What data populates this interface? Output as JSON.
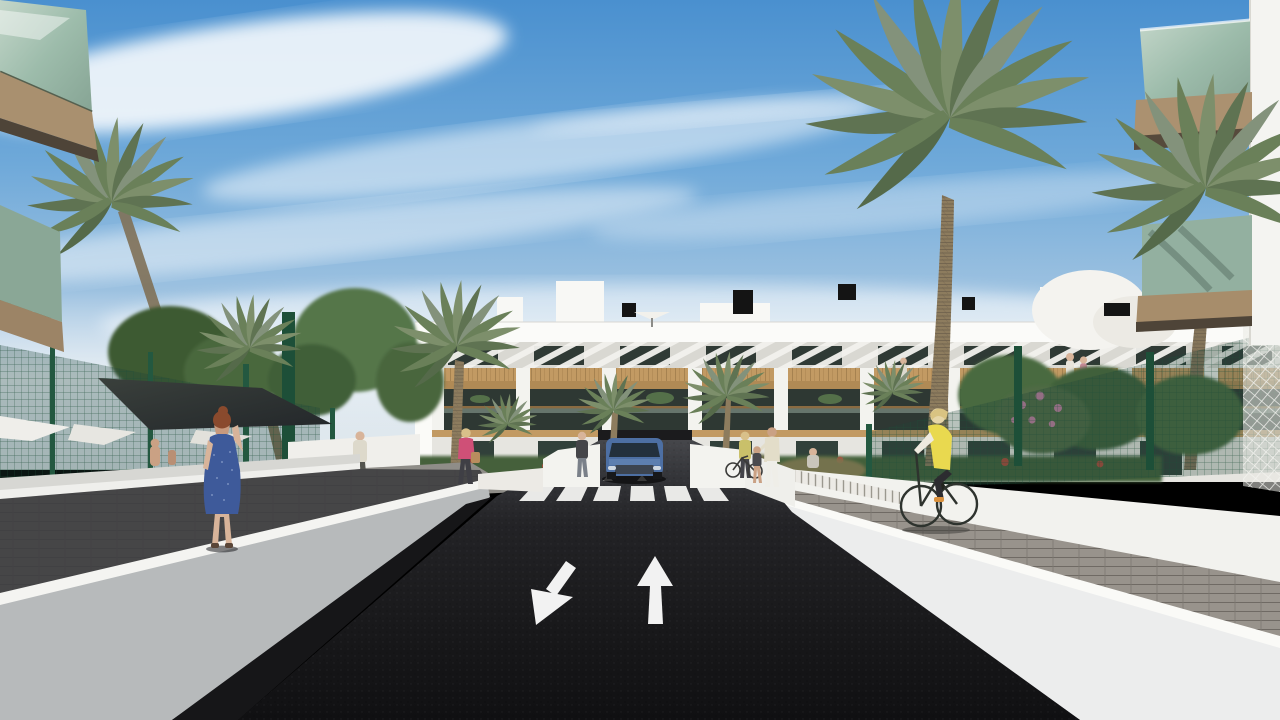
{
  "scene": {
    "kind": "architectural-3d-rendering",
    "description": "Exterior render of a modern white Mediterranean apartment complex seen from its entrance road: palm trees, green mesh garden fences, white retaining walls, a zebra crosswalk, a blue car on the garage ramp, pedestrians and a cyclist in a yellow vest.",
    "road_markings": {
      "left_lane_arrow": "down-left (towards viewer)",
      "right_lane_arrow": "up (away from viewer)",
      "crosswalk_stripes": 6
    },
    "objects": [
      "sky-with-cirrus-clouds",
      "apartment-building",
      "roof-chimneys",
      "roof-umbrella",
      "louvered-attic-facade",
      "wood-cladding-band",
      "glass-balconies",
      "garage-ramp",
      "blue-car",
      "zebra-crosswalk",
      "lane-arrows",
      "asphalt-road",
      "left-retaining-wall",
      "left-shaded-walkway",
      "right-retaining-wall",
      "right-paver-walkway",
      "green-mesh-fences",
      "white-lattice-fence",
      "shade-sail",
      "parasols",
      "palm-trees",
      "leafy-trees",
      "flower-bushes",
      "woman-in-blue-dress-on-phone",
      "pedestrian-on-path",
      "woman-pink-top-with-handbag",
      "woman-dark-top",
      "woman-with-bicycle",
      "adult-with-child",
      "seated-person",
      "cyclist-yellow-vest",
      "balcony-residents",
      "foreground-left-balcony-corner",
      "foreground-right-balcony-corner"
    ]
  },
  "colors": {
    "sky_top": "#4a90cf",
    "sky_mid": "#85b5de",
    "sky_horizon": "#dde5ea",
    "cloud": "#ffffff",
    "building_white": "#f6f6f3",
    "building_shade": "#e3e2dd",
    "wood": "#c29a63",
    "wood_dark": "#8a6a3e",
    "window_dark": "#2f3a35",
    "glass_green": "#a7c2b2",
    "fence_green": "#2e6b4f",
    "foliage_dark": "#39572f",
    "foliage_mid": "#547444",
    "palm_green": "#7d8f6b",
    "palm_green_dark": "#5f7352",
    "trunk_brown": "#8d7c5e",
    "road_dark": "#1e1e20",
    "marking_white": "#f2f2f2",
    "wall_gray": "#b7babb",
    "wall_bright": "#eceded",
    "paver_gray": "#98938c",
    "shadow_dark": "#2b2b2e",
    "car_blue": "#4d6fa3",
    "vest_yellow": "#e9d94f",
    "dress_blue": "#3e5a9a",
    "hair_auburn": "#8a4a2d",
    "skin": "#d8b49a",
    "pink_top": "#cf5077",
    "flower_pink": "#c07fa0",
    "flower_red": "#b84a3c",
    "sail_dark": "#2e3330"
  }
}
